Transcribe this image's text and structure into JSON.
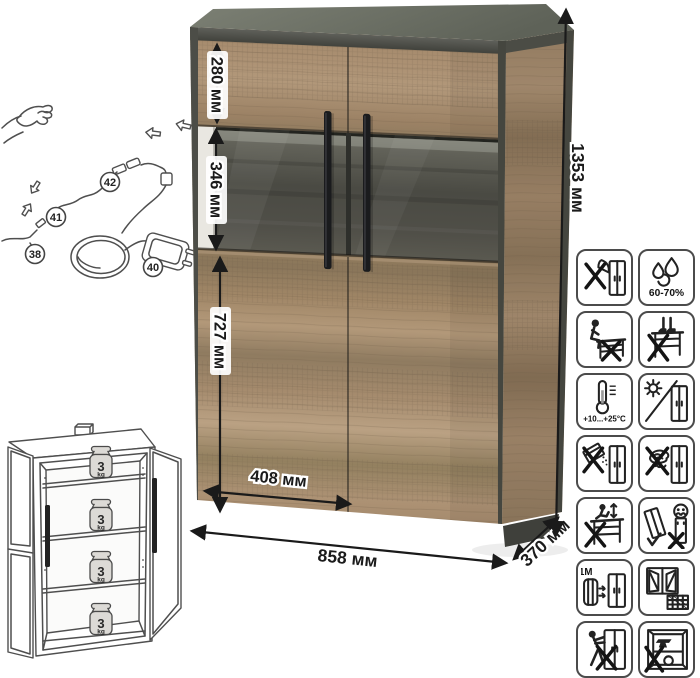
{
  "colors": {
    "wood_light": "#b89c7d",
    "wood_mid": "#a18669",
    "wood_dark": "#8a755c",
    "frame_dark": "#4b4c46",
    "top_face": "#6b6f64",
    "glass_back": "#55544d",
    "handle_black": "#1b1c1e",
    "line_art": "#4f4f4f",
    "dimension_text": "#1b1b1b"
  },
  "dimensions": {
    "top_section_height": "280 мм",
    "display_section_height": "346 мм",
    "lower_section_height": "727 мм",
    "door_width": "408 мм",
    "total_width": "858 мм",
    "depth": "370 мм",
    "total_height": "1353 мм"
  },
  "lighting_diagram": {
    "callouts": [
      {
        "id": "42"
      },
      {
        "id": "41"
      },
      {
        "id": "38"
      },
      {
        "id": "40"
      }
    ]
  },
  "shelf_load_diagram": {
    "shelves": [
      {
        "value": "3",
        "unit": "kg"
      },
      {
        "value": "3",
        "unit": "kg"
      },
      {
        "value": "3",
        "unit": "kg"
      },
      {
        "value": "3",
        "unit": "kg"
      }
    ]
  },
  "care_icons": {
    "humidity_text": "60-70%",
    "temperature_text": "+10...+25°C",
    "distance_text": "≥1M",
    "items": [
      {
        "name": "no-sharp-tools-icon"
      },
      {
        "name": "humidity-60-70-icon"
      },
      {
        "name": "no-sitting-icon"
      },
      {
        "name": "no-standing-icon"
      },
      {
        "name": "temperature-range-icon"
      },
      {
        "name": "no-direct-sunlight-icon"
      },
      {
        "name": "no-abrasive-cleaners-icon"
      },
      {
        "name": "no-scouring-pads-icon"
      },
      {
        "name": "no-jumping-icon"
      },
      {
        "name": "carry-upright-two-people-icon"
      },
      {
        "name": "keep-1m-from-heat-icon"
      },
      {
        "name": "ventilate-room-icon"
      },
      {
        "name": "no-pushing-icon"
      },
      {
        "name": "no-overloading-icon"
      }
    ]
  }
}
